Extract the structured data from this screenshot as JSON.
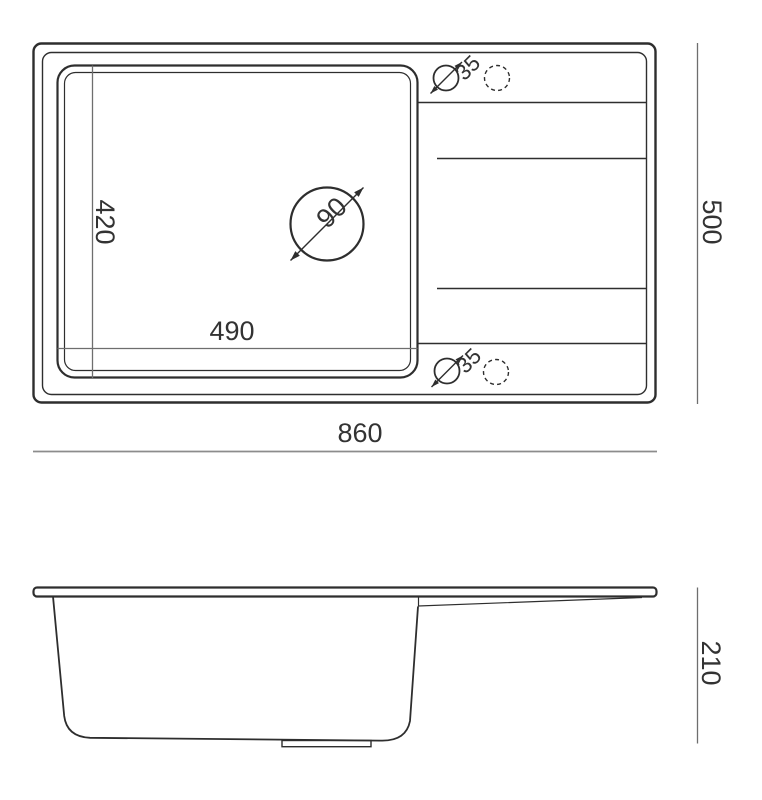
{
  "colors": {
    "line": "#2e2e2e",
    "dimension_line": "#8c8c8c",
    "text": "#333333",
    "background": "#ffffff"
  },
  "top_view": {
    "dims": {
      "overall_width": "860",
      "overall_depth": "500",
      "bowl_width": "490",
      "bowl_depth": "420",
      "drain_hole_diameter": "90",
      "tap_hole_top_diameter": "35",
      "tap_hole_bottom_diameter": "35"
    }
  },
  "side_view": {
    "dims": {
      "overall_height": "210"
    }
  }
}
